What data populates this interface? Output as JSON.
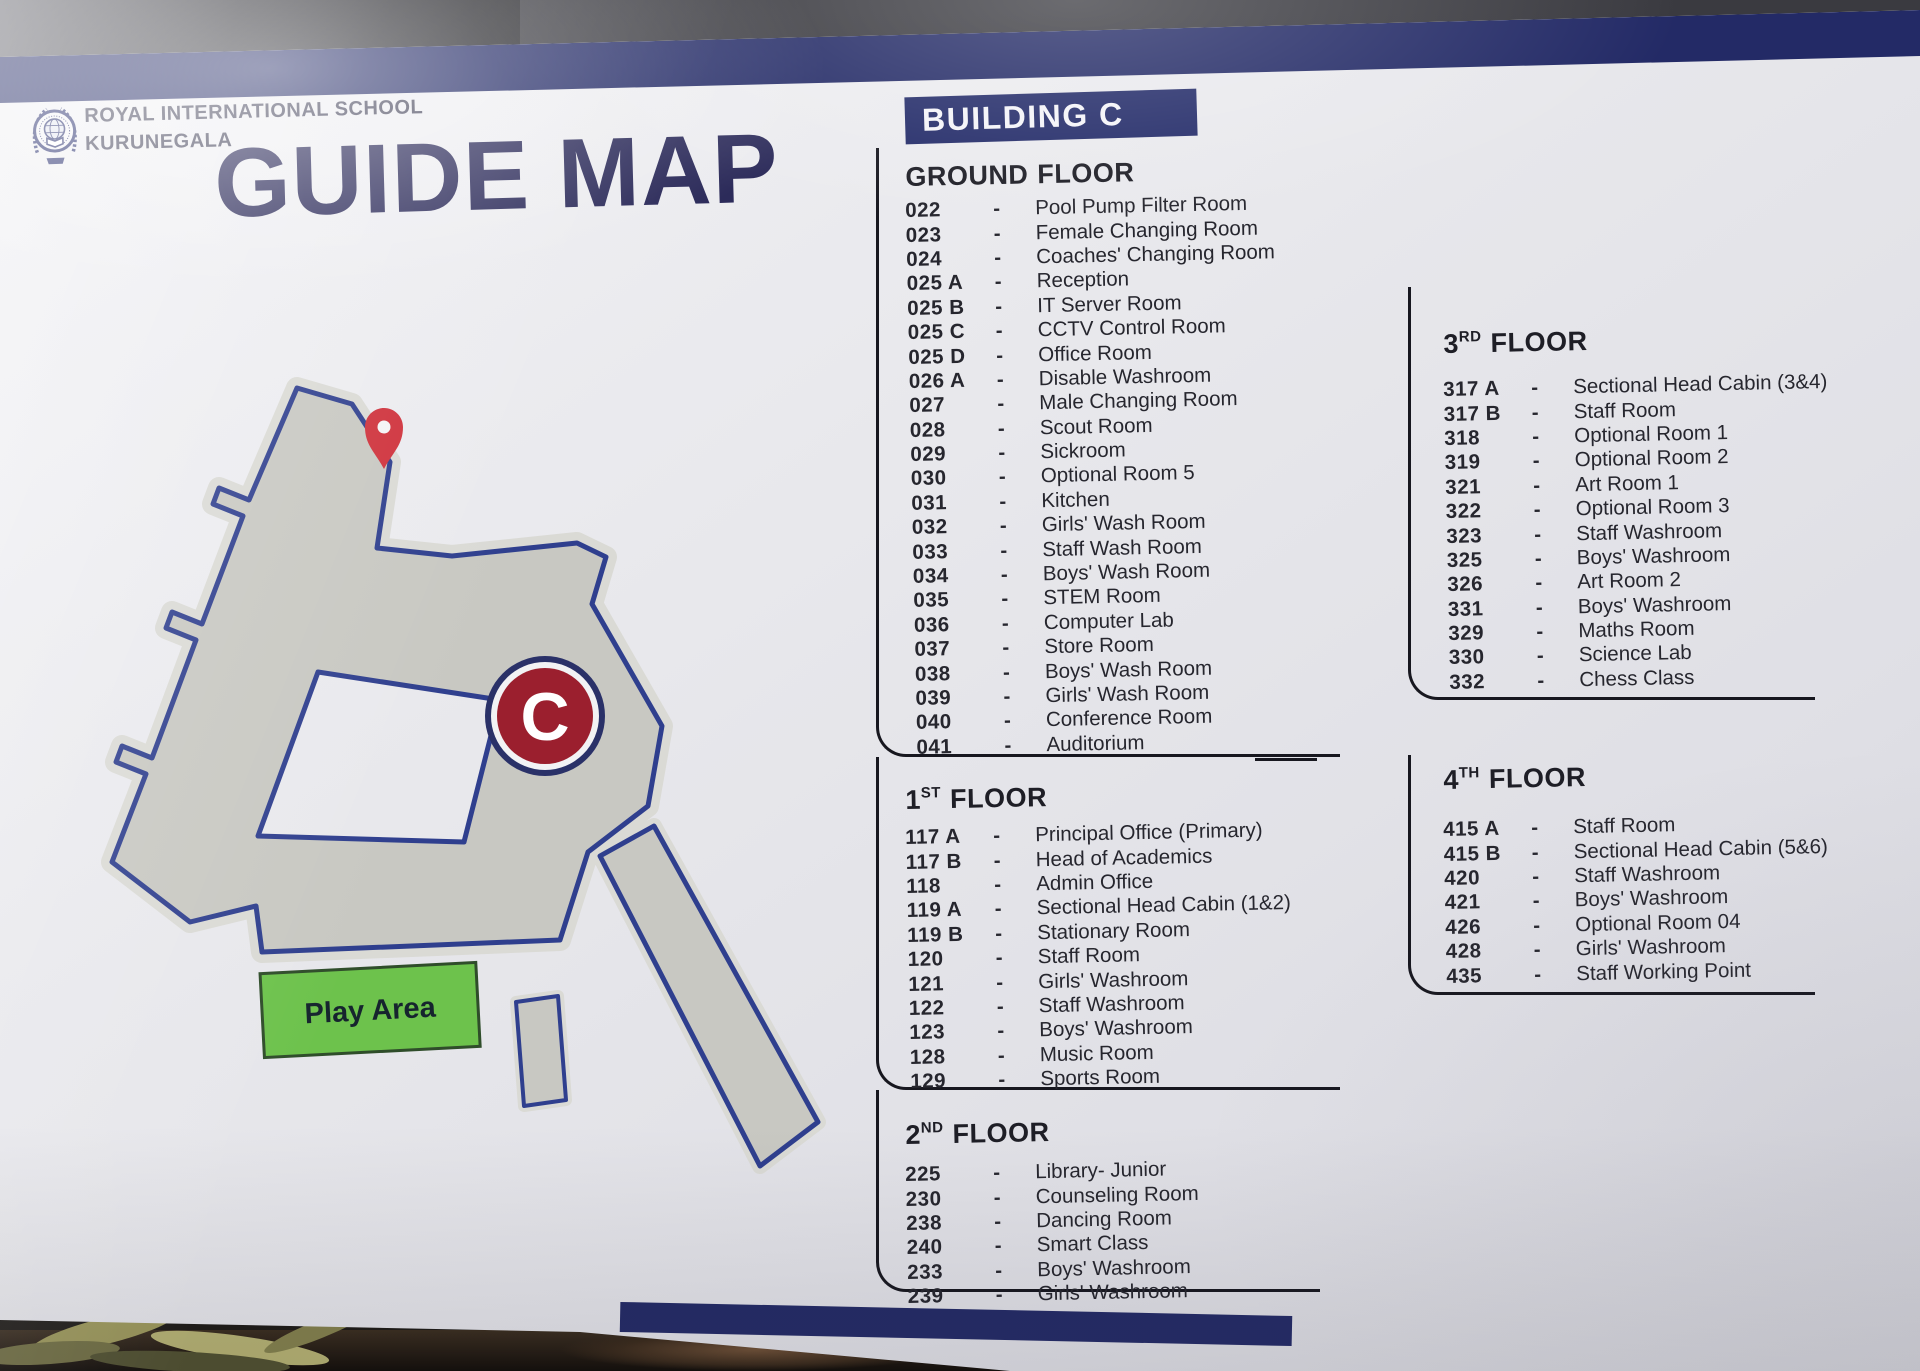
{
  "sign": {
    "school_line1": "ROYAL INTERNATIONAL SCHOOL",
    "school_line2": "KURUNEGALA",
    "title": "GUIDE MAP",
    "banner": "BUILDING C"
  },
  "map": {
    "play_area": "Play Area",
    "marker": "C"
  },
  "separator": "-",
  "colors": {
    "navy": "#232a66",
    "map_outline": "#2f3f8e",
    "building_gray": "#c8c8c2",
    "pin_red": "#cf323c",
    "badge_red": "#9b1f2e",
    "play_green": "#6dc24c"
  },
  "floors": [
    {
      "id": "ground",
      "column": "left",
      "label": "GROUND",
      "sup": "",
      "word": "FLOOR",
      "rooms": [
        {
          "num": "022",
          "name": "Pool Pump Filter Room"
        },
        {
          "num": "023",
          "name": "Female Changing Room"
        },
        {
          "num": "024",
          "name": "Coaches' Changing Room"
        },
        {
          "num": "025 A",
          "name": "Reception"
        },
        {
          "num": "025 B",
          "name": "IT Server Room"
        },
        {
          "num": "025 C",
          "name": "CCTV Control Room"
        },
        {
          "num": "025 D",
          "name": "Office Room"
        },
        {
          "num": "026 A",
          "name": "Disable Washroom"
        },
        {
          "num": "027",
          "name": "Male Changing Room"
        },
        {
          "num": "028",
          "name": "Scout Room"
        },
        {
          "num": "029",
          "name": "Sickroom"
        },
        {
          "num": "030",
          "name": "Optional Room 5"
        },
        {
          "num": "031",
          "name": "Kitchen"
        },
        {
          "num": "032",
          "name": "Girls' Wash Room"
        },
        {
          "num": "033",
          "name": "Staff Wash Room"
        },
        {
          "num": "034",
          "name": "Boys' Wash Room"
        },
        {
          "num": "035",
          "name": "STEM Room"
        },
        {
          "num": "036",
          "name": "Computer Lab"
        },
        {
          "num": "037",
          "name": "Store Room"
        },
        {
          "num": "038",
          "name": "Boys' Wash Room"
        },
        {
          "num": "039",
          "name": "Girls' Wash Room"
        },
        {
          "num": "040",
          "name": "Conference Room"
        },
        {
          "num": "041",
          "name": "Auditorium"
        }
      ]
    },
    {
      "id": "first",
      "column": "left",
      "label": "1",
      "sup": "ST",
      "word": "FLOOR",
      "rooms": [
        {
          "num": "117 A",
          "name": "Principal Office (Primary)"
        },
        {
          "num": "117 B",
          "name": "Head of Academics"
        },
        {
          "num": "118",
          "name": "Admin Office"
        },
        {
          "num": "119 A",
          "name": "Sectional Head Cabin (1&2)"
        },
        {
          "num": "119 B",
          "name": "Stationary Room"
        },
        {
          "num": "120",
          "name": "Staff Room"
        },
        {
          "num": "121",
          "name": "Girls' Washroom"
        },
        {
          "num": "122",
          "name": "Staff Washroom"
        },
        {
          "num": "123",
          "name": "Boys' Washroom"
        },
        {
          "num": "128",
          "name": "Music Room"
        },
        {
          "num": "129",
          "name": "Sports Room"
        }
      ]
    },
    {
      "id": "second",
      "column": "left",
      "label": "2",
      "sup": "ND",
      "word": "FLOOR",
      "rooms": [
        {
          "num": "225",
          "name": "Library- Junior"
        },
        {
          "num": "230",
          "name": "Counseling Room"
        },
        {
          "num": "238",
          "name": "Dancing Room"
        },
        {
          "num": "240",
          "name": "Smart Class"
        },
        {
          "num": "233",
          "name": "Boys' Washroom"
        },
        {
          "num": "239",
          "name": "Girls' Washroom"
        }
      ]
    },
    {
      "id": "third",
      "column": "right",
      "label": "3",
      "sup": "RD",
      "word": "FLOOR",
      "rooms": [
        {
          "num": "317 A",
          "name": "Sectional Head Cabin (3&4)"
        },
        {
          "num": "317 B",
          "name": "Staff Room"
        },
        {
          "num": "318",
          "name": "Optional Room 1"
        },
        {
          "num": "319",
          "name": "Optional Room 2"
        },
        {
          "num": "321",
          "name": "Art Room 1"
        },
        {
          "num": "322",
          "name": "Optional Room 3"
        },
        {
          "num": "323",
          "name": "Staff Washroom"
        },
        {
          "num": "325",
          "name": "Boys' Washroom"
        },
        {
          "num": "326",
          "name": "Art Room 2"
        },
        {
          "num": "331",
          "name": "Boys' Washroom"
        },
        {
          "num": "329",
          "name": "Maths Room"
        },
        {
          "num": "330",
          "name": "Science Lab"
        },
        {
          "num": "332",
          "name": "Chess Class"
        }
      ]
    },
    {
      "id": "fourth",
      "column": "right",
      "label": "4",
      "sup": "TH",
      "word": "FLOOR",
      "rooms": [
        {
          "num": "415 A",
          "name": "Staff Room"
        },
        {
          "num": "415 B",
          "name": "Sectional Head Cabin (5&6)"
        },
        {
          "num": "420",
          "name": "Staff Washroom"
        },
        {
          "num": "421",
          "name": "Boys' Washroom"
        },
        {
          "num": "426",
          "name": "Optional Room 04"
        },
        {
          "num": "428",
          "name": "Girls' Washroom"
        },
        {
          "num": "435",
          "name": "Staff Working Point"
        }
      ]
    }
  ]
}
